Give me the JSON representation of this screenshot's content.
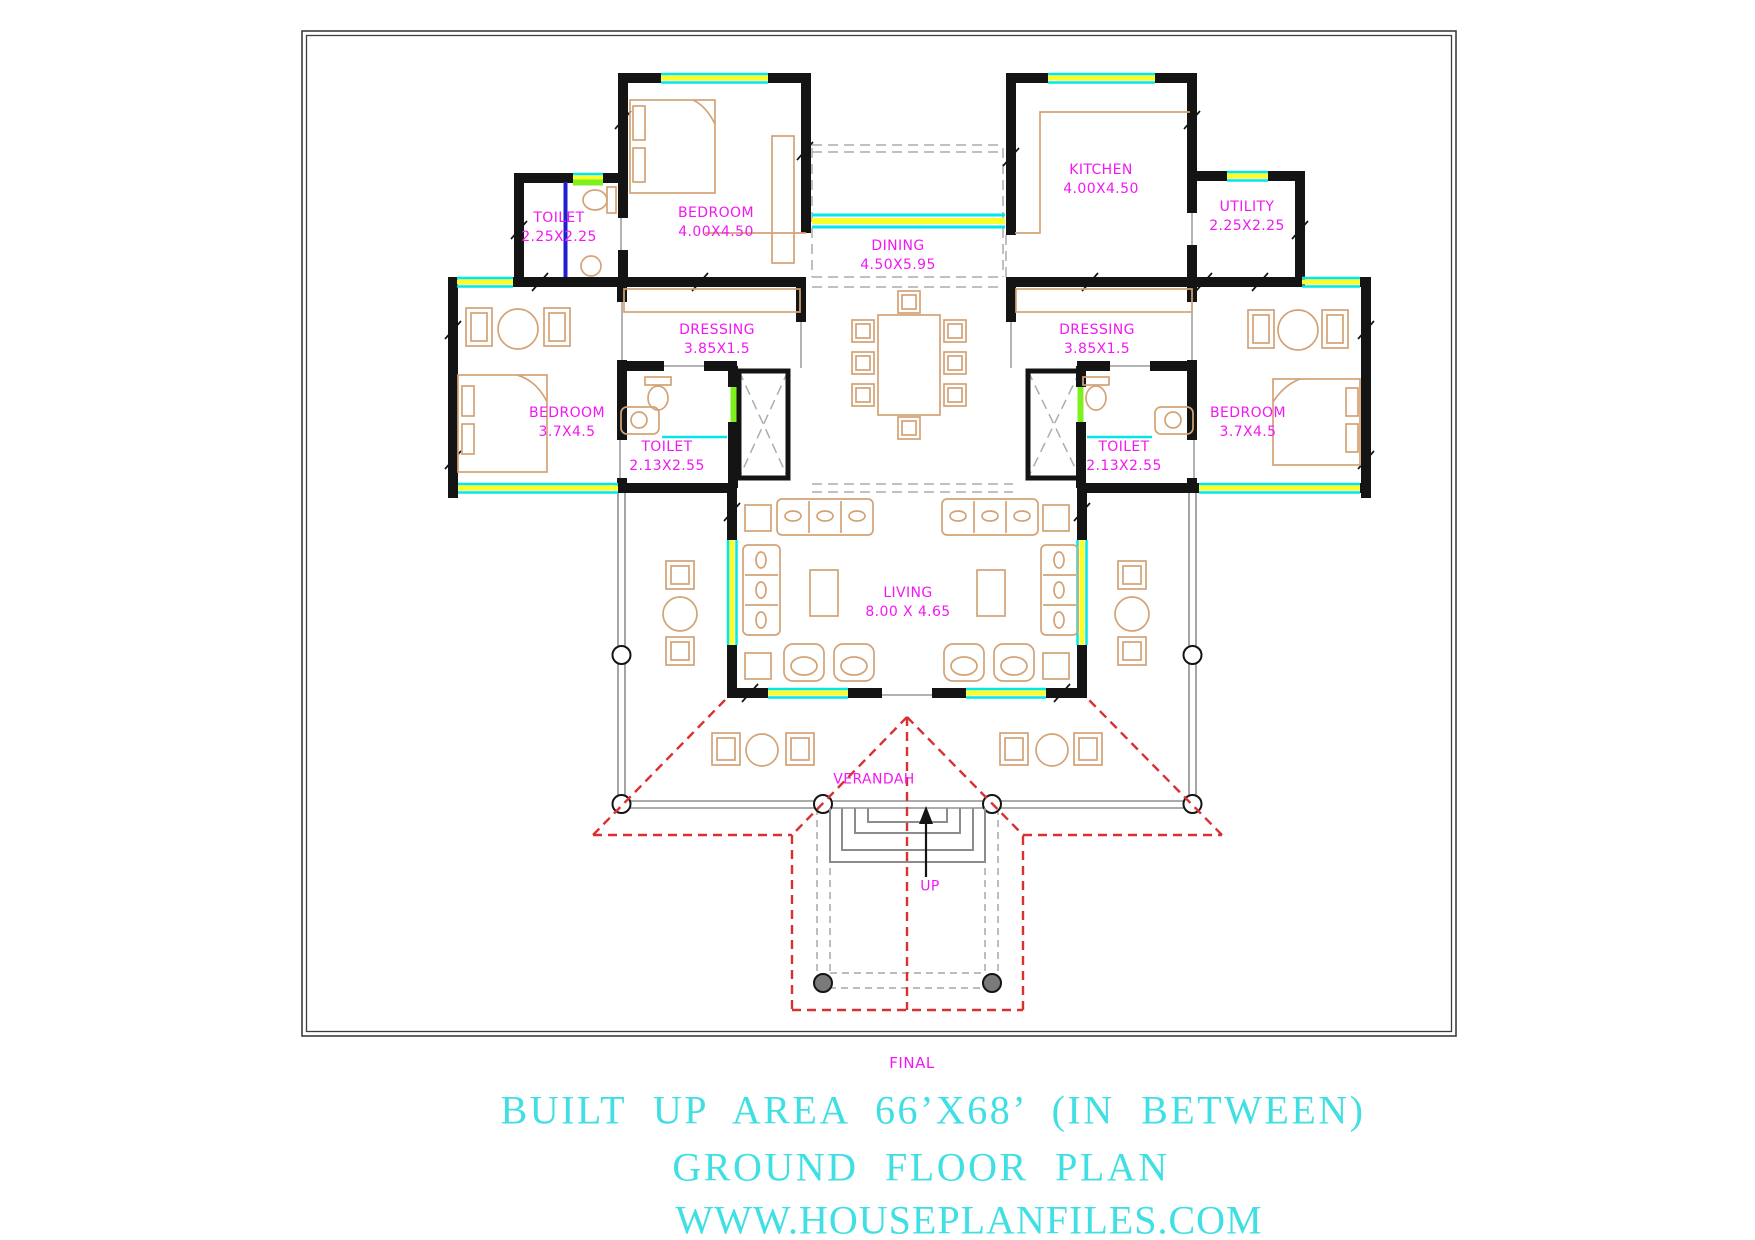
{
  "rooms": {
    "toilet_top": {
      "name": "TOILET",
      "dims": "2.25X2.25"
    },
    "bedroom_top": {
      "name": "BEDROOM",
      "dims": "4.00X4.50"
    },
    "dining": {
      "name": "DINING",
      "dims": "4.50X5.95"
    },
    "kitchen": {
      "name": "KITCHEN",
      "dims": "4.00X4.50"
    },
    "utility": {
      "name": "UTILITY",
      "dims": "2.25X2.25"
    },
    "dressing_left": {
      "name": "DRESSING",
      "dims": "3.85X1.5"
    },
    "dressing_right": {
      "name": "DRESSING",
      "dims": "3.85X1.5"
    },
    "bedroom_left": {
      "name": "BEDROOM",
      "dims": "3.7X4.5"
    },
    "bedroom_right": {
      "name": "BEDROOM",
      "dims": "3.7X4.5"
    },
    "toilet_left": {
      "name": "TOILET",
      "dims": "2.13X2.55"
    },
    "toilet_right": {
      "name": "TOILET",
      "dims": "2.13X2.55"
    },
    "living": {
      "name": "LIVING",
      "dims": "8.00 X 4.65"
    },
    "verandah": {
      "name": "VERANDAH"
    }
  },
  "annotations": {
    "up": "UP",
    "final": "FINAL"
  },
  "title_block": {
    "line1": "BUILT UP AREA 66’X68’ (IN BETWEEN)",
    "line2": "GROUND FLOOR PLAN",
    "line3": "WWW.HOUSEPLANFILES.COM"
  },
  "colors": {
    "wall": "#141414",
    "label": "#f318f3",
    "title": "#3fdfe4",
    "cyan": "#00e8e8",
    "yellow": "#fdfd2a",
    "lime": "#7df01e",
    "red": "#d93030",
    "tan": "#d3a377",
    "blue": "#1f1fd0"
  }
}
